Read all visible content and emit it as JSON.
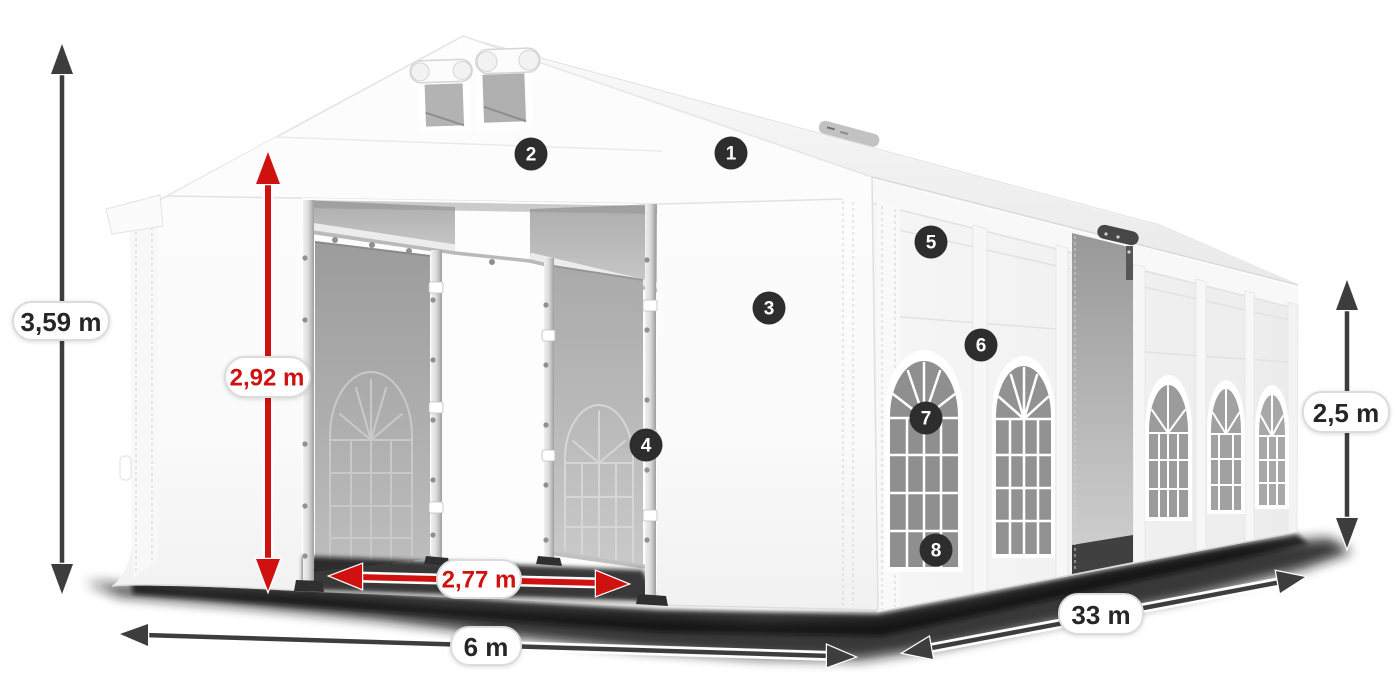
{
  "dimensions": {
    "total_height": "3,59 m",
    "entrance_height": "2,92 m",
    "entrance_width": "2,77 m",
    "front_width": "6 m",
    "length": "33 m",
    "wall_height": "2,5 m"
  },
  "badges": [
    "1",
    "2",
    "3",
    "4",
    "5",
    "6",
    "7",
    "8"
  ],
  "colors": {
    "arrow_dark": "#3d3d3d",
    "arrow_red": "#cf1110",
    "label_text_dark": "#262626",
    "label_text_red": "#cf1110",
    "pill_background": "#ffffff",
    "pill_border": "#dcdcdc",
    "badge_background": "#2d2d2d",
    "badge_text": "#ffffff",
    "tent_white": "#f7f7f7",
    "window_glass_gray": "#8f8f8f"
  }
}
